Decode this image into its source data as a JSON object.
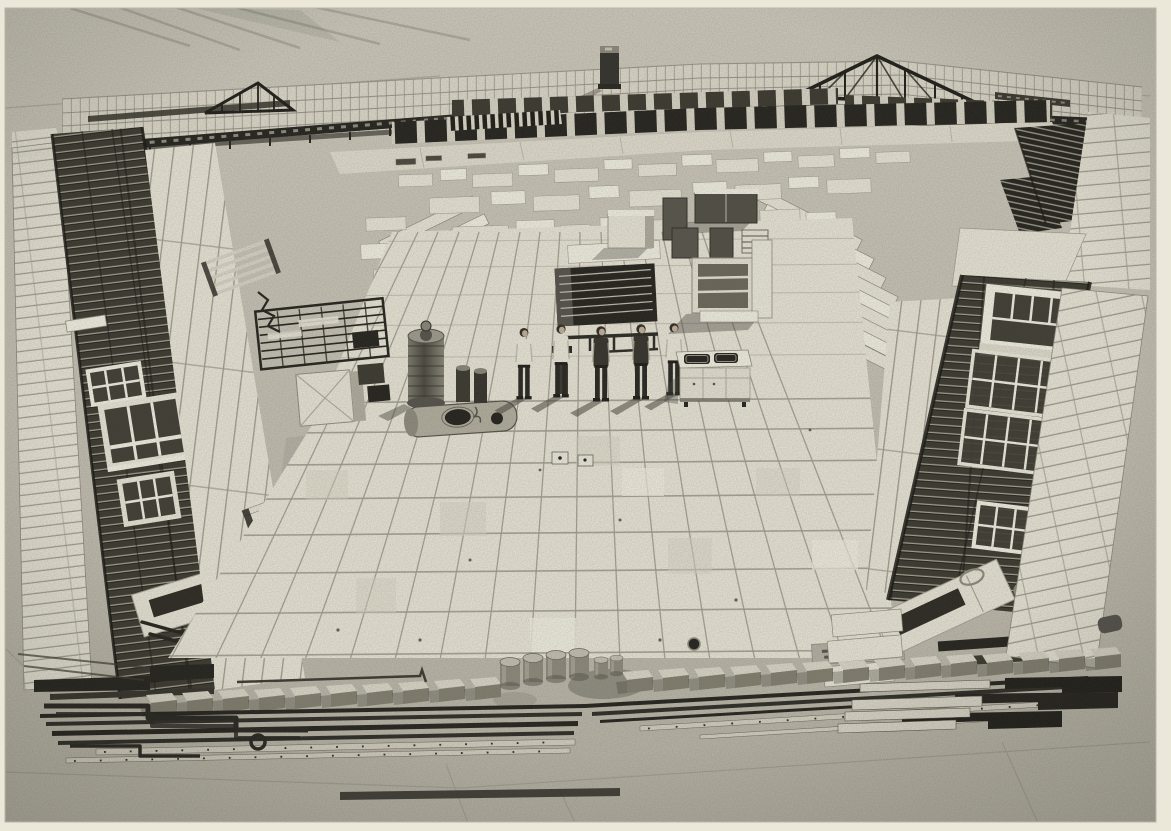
{
  "meta": {
    "type": "vintage monochrome aerial photograph",
    "aria_label": "Aerial photograph of every component of a prefabricated building laid out in an open rectangle on a concrete apron, with five workers standing in the centre",
    "description": "A complete prefab building kit knolled on tarmac: stacked wall-panel fence along the top with a flue stack and roof trusses, left and right wings of steel truss bands carrying white window frames beside columns of wall panels, a large grid of square floor panels in the centre with cabinets, shelf unit, kitchen sink unit, water-heater cylinder, tank and pipe rack, five workers posing in a row, and a bottom row of foundation blocks, steel drums, rails, channels and zig-zag pipework."
  },
  "palette": {
    "paper": "#ece8d9",
    "concrete": "#c6c2b4",
    "concreteLight": "#cfcbbd",
    "concreteDark": "#b7b3a5",
    "panelLight": "#eae7d8",
    "panelBright": "#f3f1e3",
    "panelMid": "#d9d5c6",
    "lineGray": "#a19d8f",
    "steelDark": "#23211b",
    "steelMid": "#3a372e",
    "shadow": "#45423a",
    "glass": "#3f3c33",
    "skin": "#c2b29b",
    "shirt": "#ece9da",
    "shirtDark": "#34312a",
    "trousers": "#26241f",
    "fenceLight": "#dedacb",
    "walkway": "#e2decf",
    "drumBody": "#8e8a7b",
    "drumTop": "#c5c1b2",
    "blockTop": "#dcd8c9",
    "blockFront": "#827f6f",
    "tank": "#b3af9f"
  },
  "scene": {
    "setting": "concrete apron / airfield tarmac",
    "workers": {
      "count": 5,
      "pose": "standing in a row, hands behind backs",
      "shirts": [
        "light",
        "light",
        "dark",
        "dark",
        "light"
      ]
    },
    "inventory": [
      "stacked wall-panel fence",
      "flue chimney stack",
      "lattice roof trusses",
      "A-frame gable trusses",
      "rows of dark roof panels",
      "walkway of panels",
      "left panel column",
      "left truss band with window frames",
      "three left window frames",
      "left louvre panel",
      "wall panel columns",
      "timber bundle",
      "floor beam bundles",
      "fanned panel stacks",
      "scattered small panels",
      "central floor panel grid",
      "pipe rack",
      "site hut",
      "coiled wire",
      "slatted rack",
      "storage cabinets",
      "open shelf unit",
      "kitchen sink unit",
      "water heater cylinder",
      "horizontal tank",
      "flue pipes",
      "junction boxes",
      "marked slab",
      "drain hole",
      "right truss band with window frames",
      "four right window frames",
      "right louvre panel",
      "wire hoops",
      "right tile columns",
      "dark slat racks",
      "foundation block row",
      "steel drums",
      "angle bar stack",
      "zig-zag pipe runs",
      "rail stacks",
      "drilled channel rails",
      "zig-zag angle steel",
      "beam stacks"
    ]
  }
}
